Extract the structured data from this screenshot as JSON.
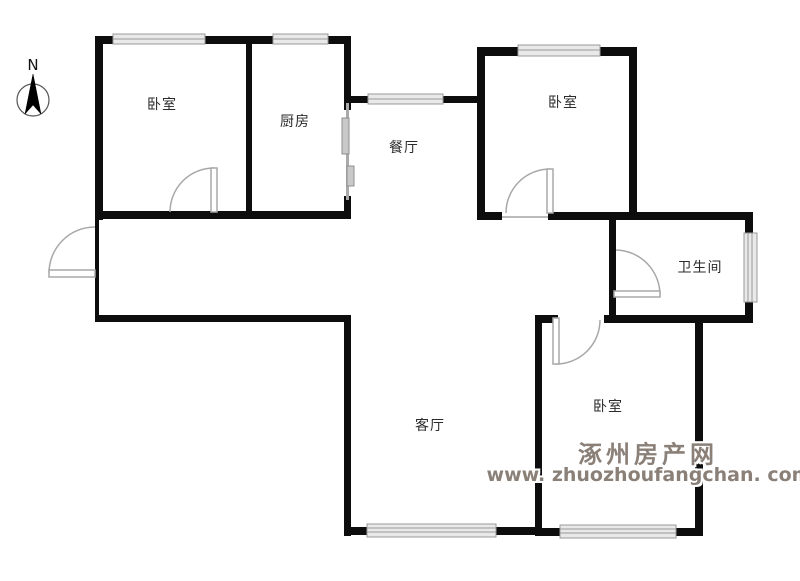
{
  "compass": {
    "label": "N"
  },
  "rooms": [
    {
      "id": "bedroom-top-left",
      "label": "卧室"
    },
    {
      "id": "kitchen",
      "label": "厨房"
    },
    {
      "id": "dining",
      "label": "餐厅"
    },
    {
      "id": "bedroom-top-right",
      "label": "卧室"
    },
    {
      "id": "bathroom",
      "label": "卫生间"
    },
    {
      "id": "living-room",
      "label": "客厅"
    },
    {
      "id": "bedroom-bottom",
      "label": "卧室"
    }
  ],
  "watermark": {
    "title": "涿州房产网",
    "url": "www. zhuozhoufangchan. com"
  },
  "colors": {
    "wall": "#0d0d0d",
    "window_fill": "#e9e9e9",
    "window_line": "#999999",
    "door_line": "#a8a8a8",
    "watermark_text": "#8a8078"
  }
}
